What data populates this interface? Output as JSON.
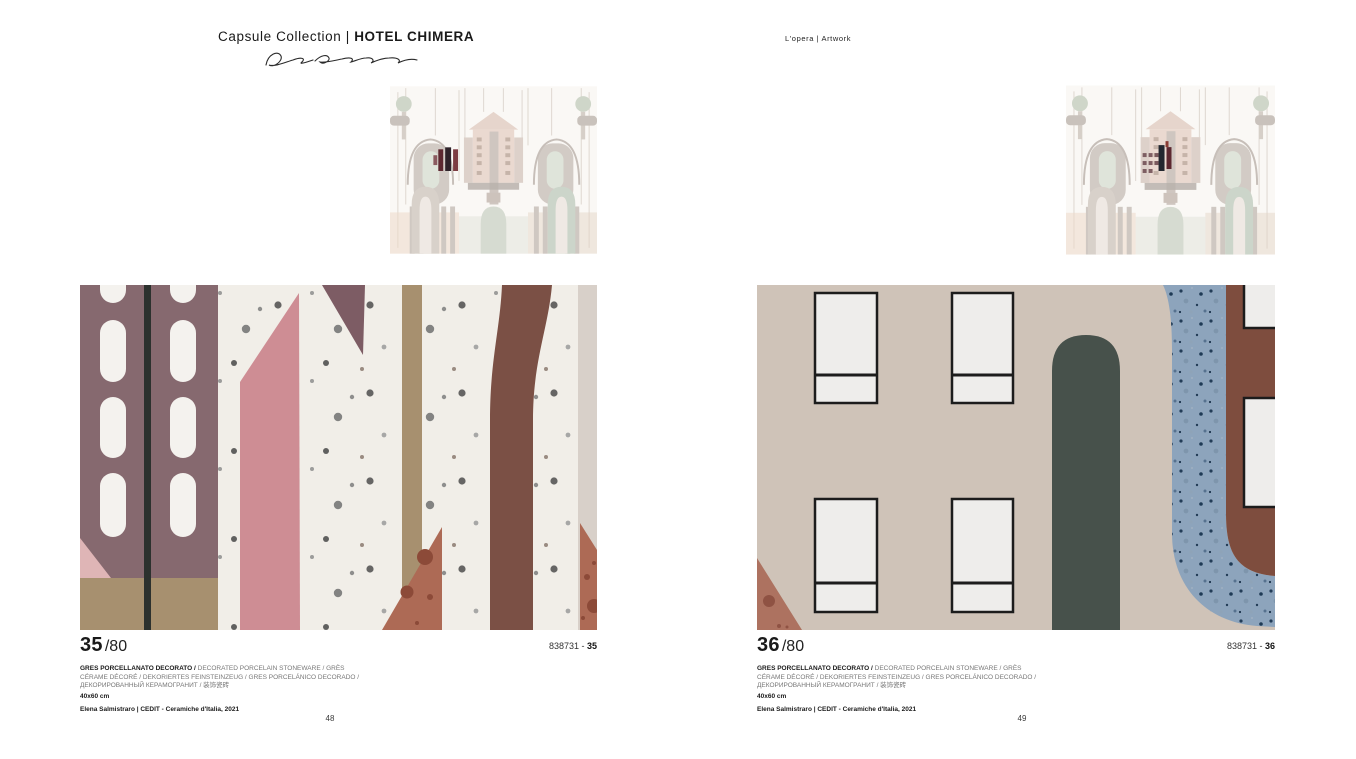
{
  "header": {
    "collection_prefix": "Capsule Collection",
    "divider": "|",
    "collection_name": "HOTEL CHIMERA",
    "section_label": "L'opera  |  Artwork"
  },
  "pages": [
    {
      "index": "35",
      "total": "/80",
      "code_prefix": "838731 - ",
      "code_number": "35",
      "desc_bold": "GRES PORCELLANATO DECORATO /",
      "desc_rest": " DECORATED PORCELAIN STONEWARE / GRÈS CÉRAME DÉCORÉ / DEKORIERTES FEINSTEINZEUG / GRES PORCELÁNICO DECORADO / ДЕКОРИРОВАННЫЙ КЕРАМОГРАНИТ / 装饰瓷砖",
      "size_label": "40x60 cm",
      "credit": "Elena Salmistraro | CEDIT - Ceramiche d'Italia, 2021",
      "page_number": "48"
    },
    {
      "index": "36",
      "total": "/80",
      "code_prefix": "838731 - ",
      "code_number": "36",
      "desc_bold": "GRES PORCELLANATO DECORATO /",
      "desc_rest": " DECORATED PORCELAIN STONEWARE / GRÈS CÉRAME DÉCORÉ / DEKORIERTES FEINSTEINZEUG / GRES PORCELÁNICO DECORADO / ДЕКОРИРОВАННЫЙ КЕРАМОГРАНИТ / 装饰瓷砖",
      "size_label": "40x60 cm",
      "credit": "Elena Salmistraro | CEDIT - Ceramiche d'Italia, 2021",
      "page_number": "49"
    }
  ],
  "colors": {
    "ink": "#1a1a1a",
    "cream": "#f1eee8",
    "mauve_panel": "#86696f",
    "mauve_triangle": "#7d5c64",
    "pink_stripe": "#ce8d94",
    "pink_light": "#dfb5b6",
    "tan": "#a7906f",
    "brown_band": "#7b5045",
    "terracotta_triangle": "#ad6a55",
    "terracotta_spot": "#8c4a38",
    "beige_stripe": "#d8d0c9",
    "black_line": "#2c312e",
    "right_bg": "#cfc3b8",
    "window_fill": "#eeedeb",
    "window_border": "#1c1c1c",
    "green_column": "#47514b",
    "blue_band": "#8da4bc",
    "terracotta_band": "#7e4d3e",
    "terracotta_corner": "#ad7260"
  }
}
